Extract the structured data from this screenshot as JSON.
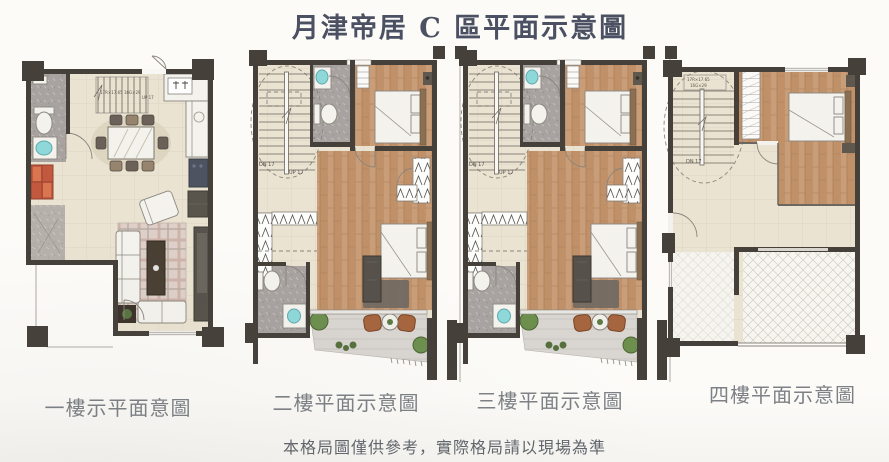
{
  "title": "月津帝居 C 區平面示意圖",
  "disclaimer": "本格局圖僅供參考，實際格局請以現場為準",
  "floors": [
    {
      "caption": "一樓示平面意圖",
      "stair_note": "17R×17.65 16G×29",
      "stair_up": "UP 17"
    },
    {
      "caption": "二樓平面示意圖",
      "stair_down": "DN 17",
      "stair_up": "UP 17"
    },
    {
      "caption": "三樓平面示意圖",
      "stair_down": "DN 17",
      "stair_up": "UP 17"
    },
    {
      "caption": "四樓平面示意圖",
      "stair_down": "DN 17",
      "stair_note_line1": "17R×17.65",
      "stair_note_line2": "16G×29"
    }
  ],
  "colors": {
    "wall": "#45403a",
    "floor_beige": "#eae3d1",
    "wood_floor": "#c89d77",
    "bath_tile": "#a8a3a0",
    "sink_cyan": "#8fd8da",
    "plant_green": "#6c8f4e",
    "patio_chair_brown": "#a5653f",
    "cabinet_red": "#c2593e",
    "title_text": "#4b5163",
    "caption_text": "#7d8186"
  }
}
